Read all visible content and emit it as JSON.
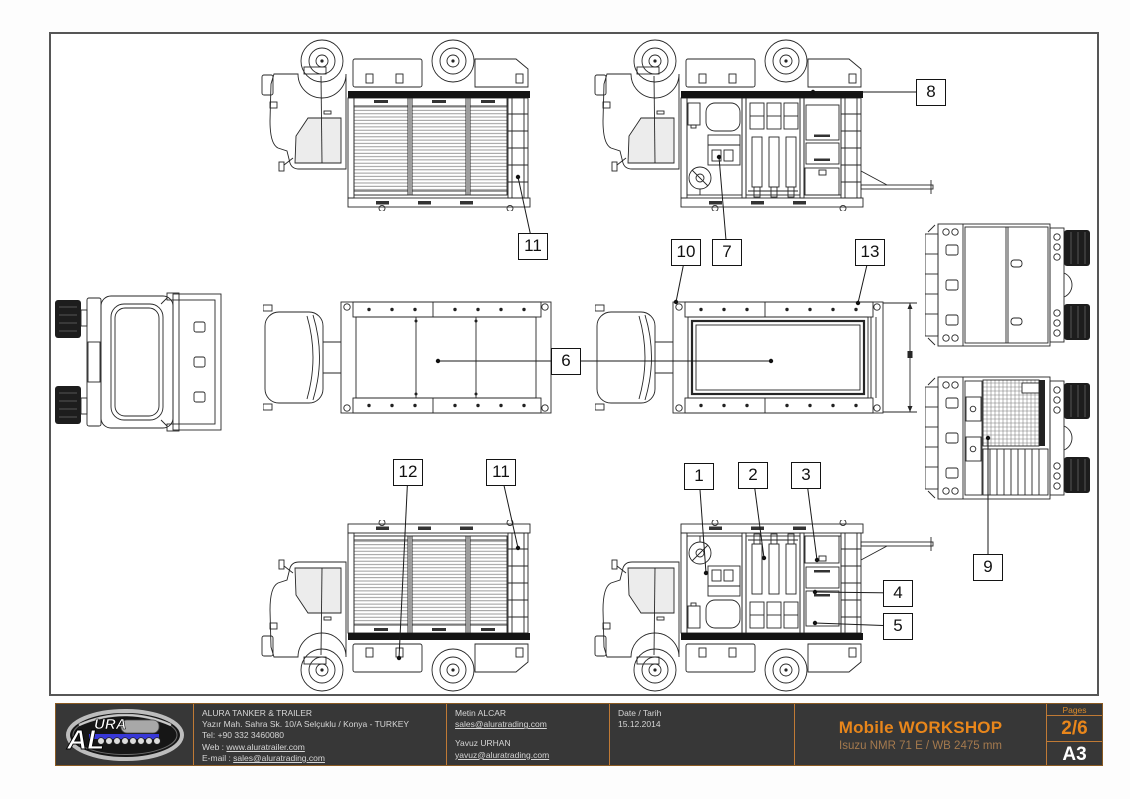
{
  "logo": {
    "al": "AL",
    "ura": "URA"
  },
  "title_block": {
    "company": {
      "name": "ALURA TANKER & TRAILER",
      "address": "Yazır Mah. Sahra Sk. 10/A Selçuklu / Konya - TURKEY",
      "tel": "Tel: +90 332 3460080",
      "web_label": "Web : ",
      "web": "www.aluratrailer.com",
      "email_label": "E-mail : ",
      "email": "sales@aluratrading.com"
    },
    "contacts": [
      {
        "name": "Metin ALCAR",
        "email": "sales@aluratrading.com"
      },
      {
        "name": "Yavuz URHAN",
        "email": "yavuz@aluratrading.com"
      }
    ],
    "date_label": "Date / Tarih",
    "date_value": "15.12.2014",
    "title": "Mobile WORKSHOP",
    "subtitle": "Isuzu NMR 71 E / WB 2475 mm",
    "pages_label": "Pages",
    "page_number": "2/6",
    "paper_size": "A3"
  },
  "colors": {
    "accent_orange": "#e8861b",
    "subtitle_tan": "#a57a4e",
    "titleblock_bg": "#373737",
    "titleblock_border": "#c07a35",
    "line_art": "#262626"
  },
  "callouts": [
    {
      "name": "callout-11-top",
      "label": "11",
      "x": 533,
      "y": 246,
      "targets": [
        [
          518,
          177
        ]
      ]
    },
    {
      "name": "callout-8",
      "label": "8",
      "x": 931,
      "y": 92,
      "targets": [
        [
          813,
          92
        ]
      ]
    },
    {
      "name": "callout-10",
      "label": "10",
      "x": 686,
      "y": 252,
      "targets": [
        [
          676,
          302
        ]
      ]
    },
    {
      "name": "callout-7",
      "label": "7",
      "x": 727,
      "y": 252,
      "targets": [
        [
          719,
          157
        ]
      ]
    },
    {
      "name": "callout-13",
      "label": "13",
      "x": 870,
      "y": 252,
      "targets": [
        [
          858,
          303
        ]
      ]
    },
    {
      "name": "callout-6",
      "label": "6",
      "x": 566,
      "y": 361,
      "targets": [
        [
          438,
          361
        ],
        [
          771,
          361
        ]
      ]
    },
    {
      "name": "callout-9",
      "label": "9",
      "x": 988,
      "y": 567,
      "targets": [
        [
          988,
          438
        ]
      ]
    },
    {
      "name": "callout-12",
      "label": "12",
      "x": 408,
      "y": 472,
      "targets": [
        [
          399,
          658
        ]
      ]
    },
    {
      "name": "callout-11-bottom",
      "label": "11",
      "x": 501,
      "y": 472,
      "targets": [
        [
          518,
          548
        ]
      ]
    },
    {
      "name": "callout-1",
      "label": "1",
      "x": 699,
      "y": 476,
      "targets": [
        [
          706,
          573
        ]
      ]
    },
    {
      "name": "callout-2",
      "label": "2",
      "x": 753,
      "y": 475,
      "targets": [
        [
          764,
          558
        ]
      ]
    },
    {
      "name": "callout-3",
      "label": "3",
      "x": 806,
      "y": 475,
      "targets": [
        [
          817,
          560
        ]
      ]
    },
    {
      "name": "callout-4",
      "label": "4",
      "x": 898,
      "y": 593,
      "targets": [
        [
          815,
          592
        ]
      ]
    },
    {
      "name": "callout-5",
      "label": "5",
      "x": 898,
      "y": 626,
      "targets": [
        [
          815,
          623
        ]
      ]
    }
  ]
}
